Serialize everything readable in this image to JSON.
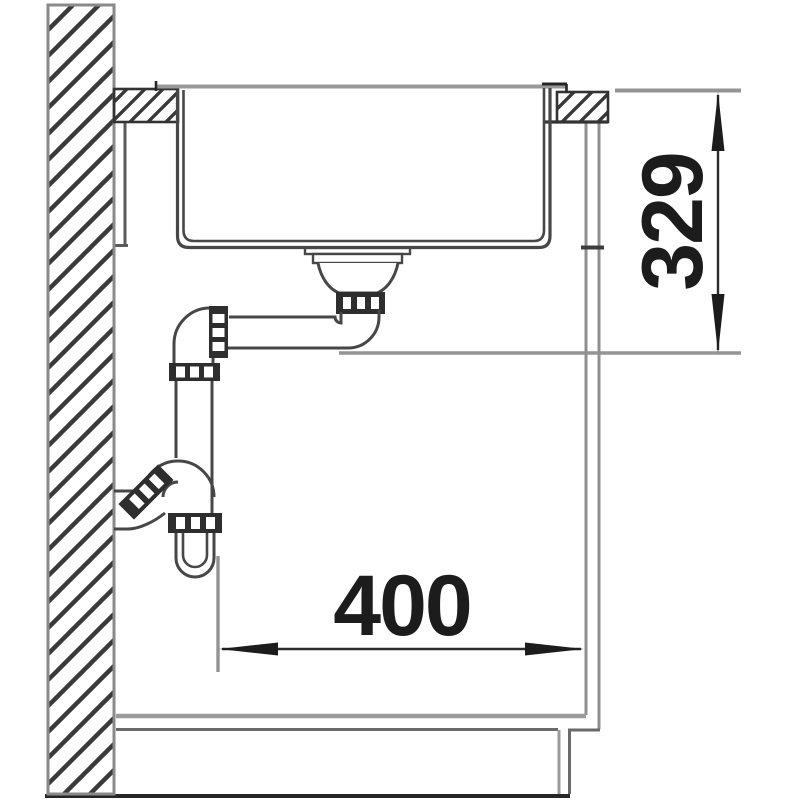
{
  "drawing": {
    "kind": "technical installation side-section of kitchen sink with siphon and cabinet",
    "dimensions": {
      "vertical": {
        "label": "329",
        "orientation": "rotated-90-ccw",
        "position": "right side, worktop to drain outlet level"
      },
      "horizontal": {
        "label": "400",
        "orientation": "horizontal",
        "position": "bottom center, trap axis to cabinet front"
      }
    }
  },
  "colors": {
    "background": "#ffffff",
    "line_dark": "#474747",
    "line_black": "#262626",
    "line_gray": "#949494",
    "hatch": "#3a3a3a",
    "fitting_fill": "#2e2e2e",
    "dim_text": "#1c1c1c"
  }
}
